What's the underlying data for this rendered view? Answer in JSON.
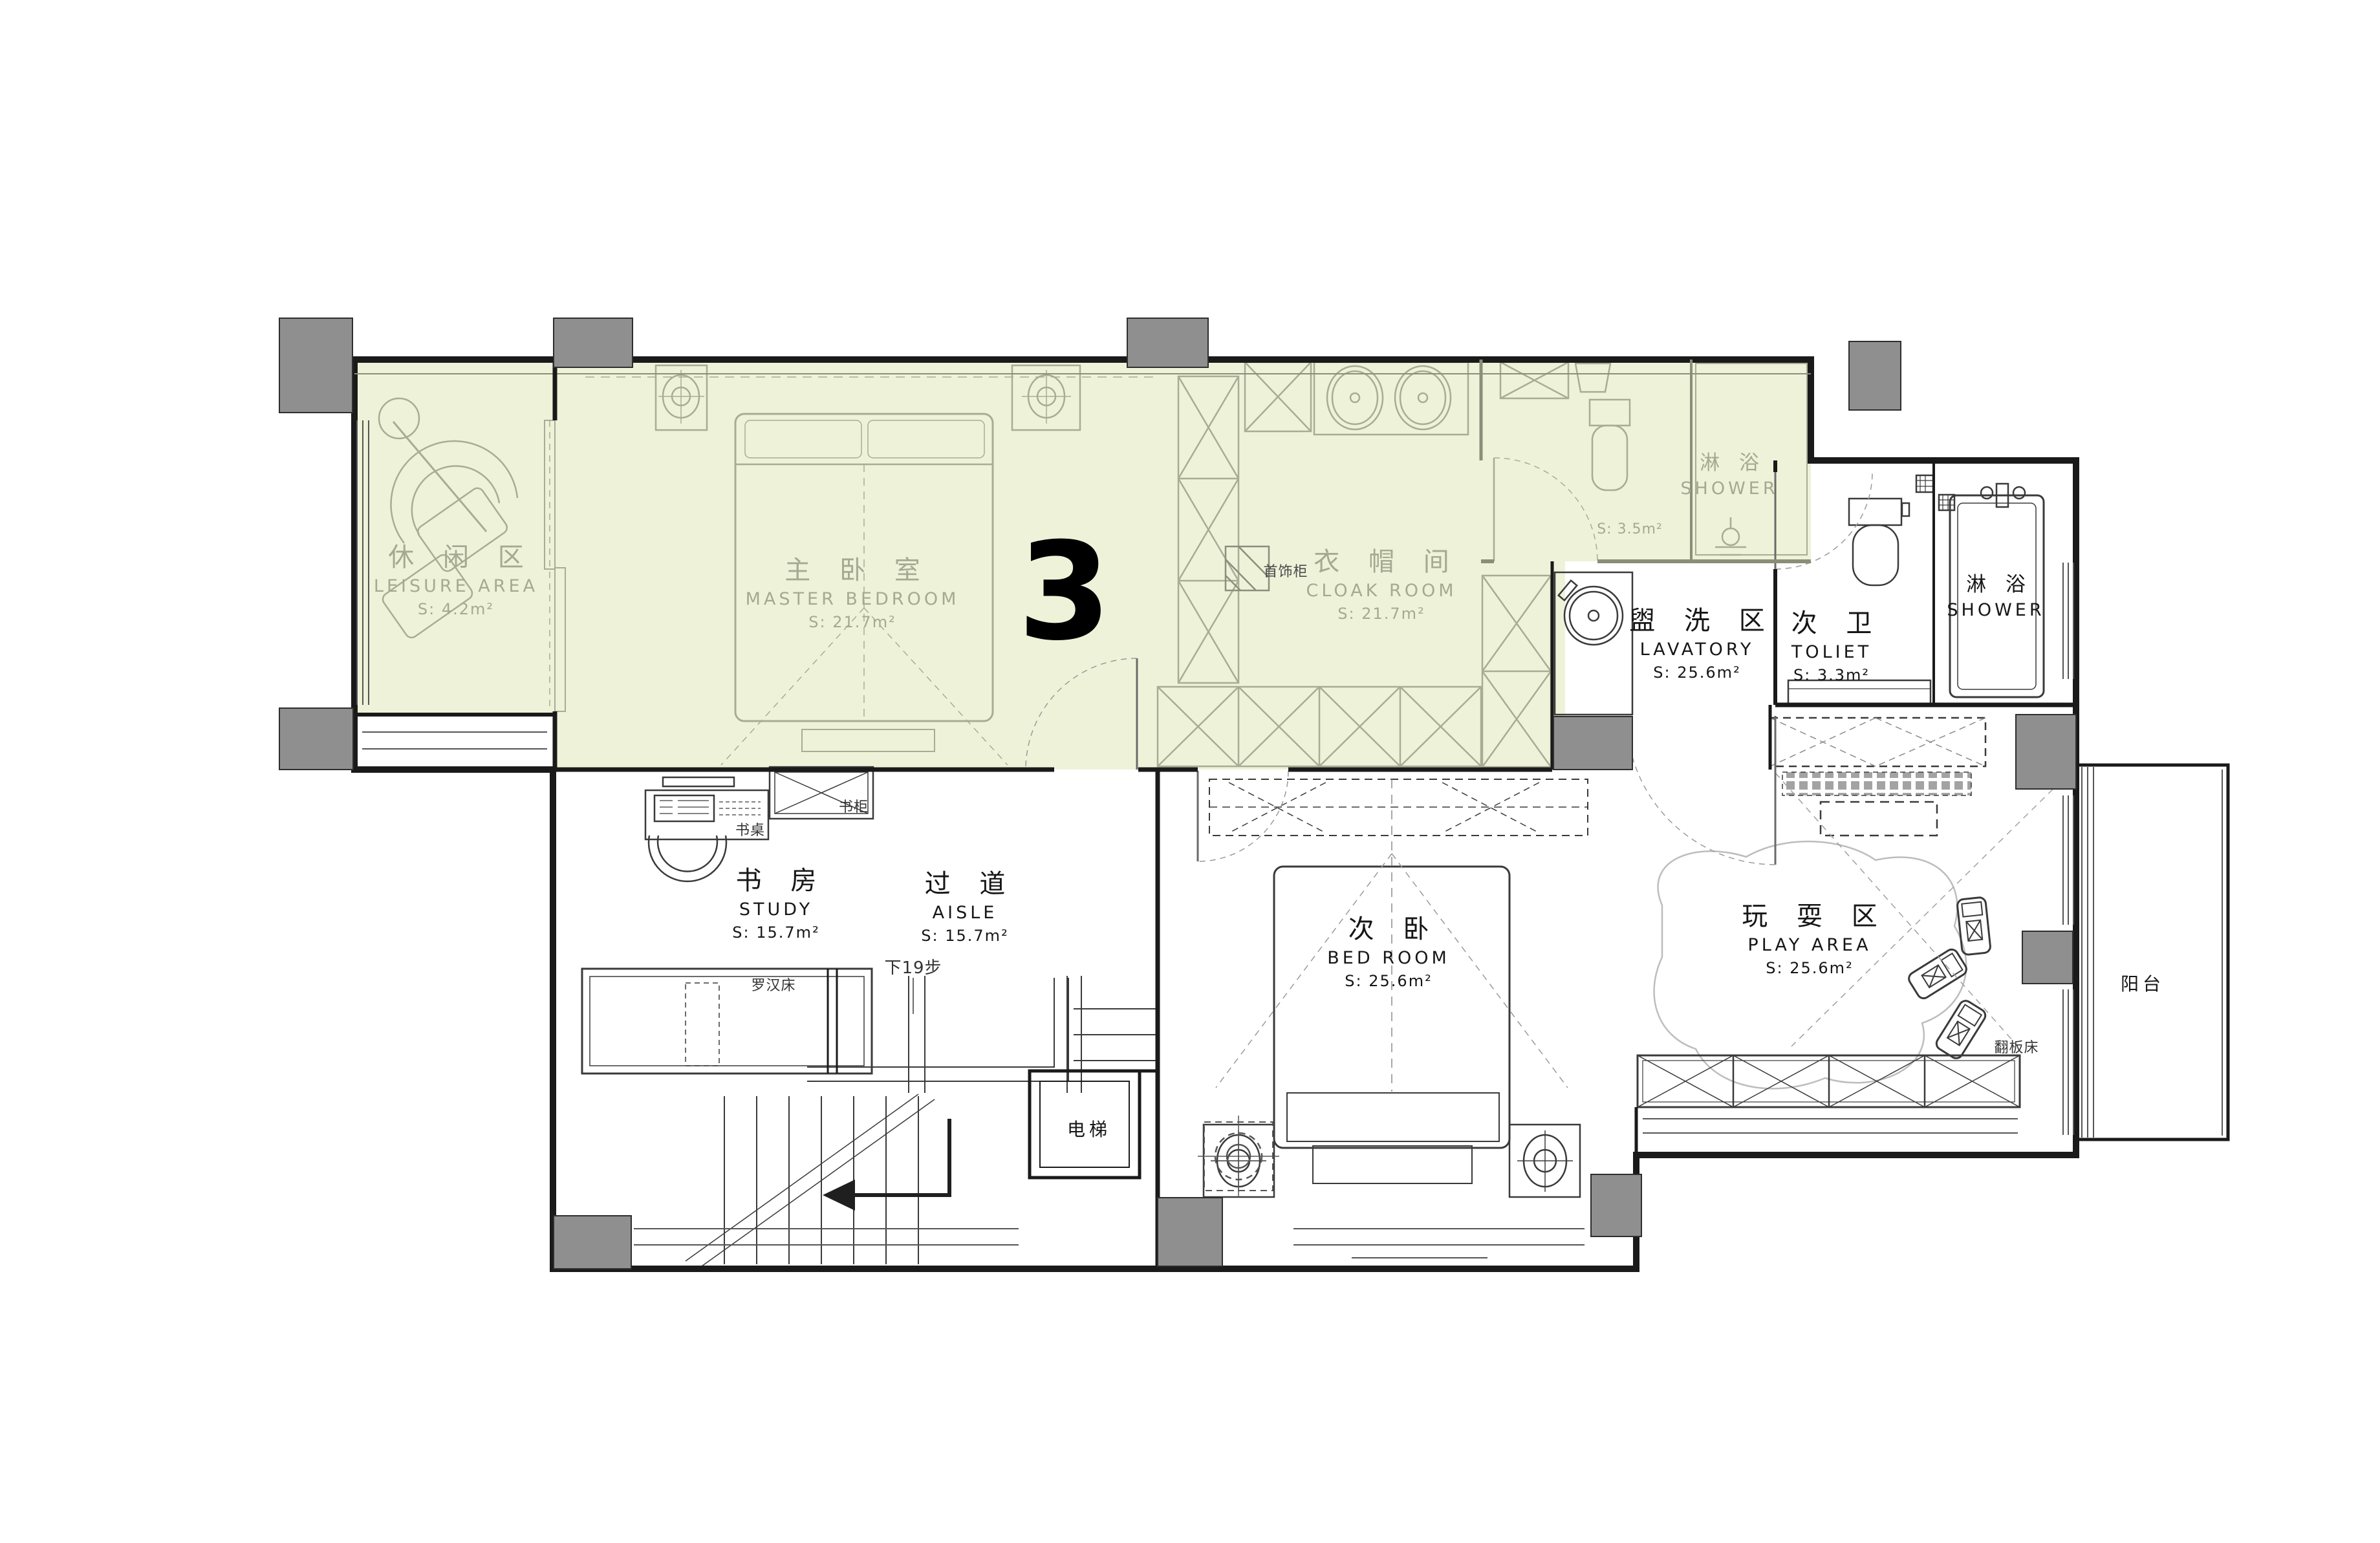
{
  "floor_number": "3",
  "colors": {
    "highlight": "#eef2d9",
    "wall": "#1a1a1a",
    "muted_line": "#a9ac95",
    "pillar": "#8f8f8f",
    "muted_text": "#a6a992",
    "dark_text": "#161616"
  },
  "rooms": [
    {
      "id": "leisure",
      "zh": "休 闲 区",
      "en": "LEISURE AREA",
      "area": "S: 4.2m²"
    },
    {
      "id": "master-bedroom",
      "zh": "主 卧 室",
      "en": "MASTER BEDROOM",
      "area": "S: 21.7m²"
    },
    {
      "id": "cloak-room",
      "zh": "衣 帽 间",
      "en": "CLOAK ROOM",
      "area": "S: 21.7m²"
    },
    {
      "id": "master-shower",
      "zh": "淋 浴",
      "en": "SHOWER",
      "area": ""
    },
    {
      "id": "lavatory",
      "zh": "盥 洗 区",
      "en": "LAVATORY",
      "area": "S: 25.6m²"
    },
    {
      "id": "toilet",
      "zh": "次 卫",
      "en": "TOLIET",
      "area": "S: 3.3m²"
    },
    {
      "id": "shower",
      "zh": "淋 浴",
      "en": "SHOWER",
      "area": ""
    },
    {
      "id": "study",
      "zh": "书 房",
      "en": "STUDY",
      "area": "S: 15.7m²"
    },
    {
      "id": "aisle",
      "zh": "过 道",
      "en": "AISLE",
      "area": "S: 15.7m²"
    },
    {
      "id": "bedroom",
      "zh": "次 卧",
      "en": "BED  ROOM",
      "area": "S: 25.6m²"
    },
    {
      "id": "play-area",
      "zh": "玩 耍 区",
      "en": "PLAY  AREA",
      "area": "S: 25.6m²"
    },
    {
      "id": "balcony",
      "zh": "阳台",
      "en": "",
      "area": ""
    },
    {
      "id": "elevator",
      "zh": "电梯",
      "en": "",
      "area": ""
    }
  ],
  "annotations": [
    {
      "id": "master-bath-area",
      "text": "S: 3.5m²"
    },
    {
      "id": "jewelry-cabinet",
      "text": "首饰柜"
    },
    {
      "id": "desk",
      "text": "书桌"
    },
    {
      "id": "bookcase",
      "text": "书柜"
    },
    {
      "id": "daybed",
      "text": "罗汉床"
    },
    {
      "id": "steps-down",
      "text": "下19步"
    },
    {
      "id": "flip-bed",
      "text": "翻板床"
    }
  ]
}
